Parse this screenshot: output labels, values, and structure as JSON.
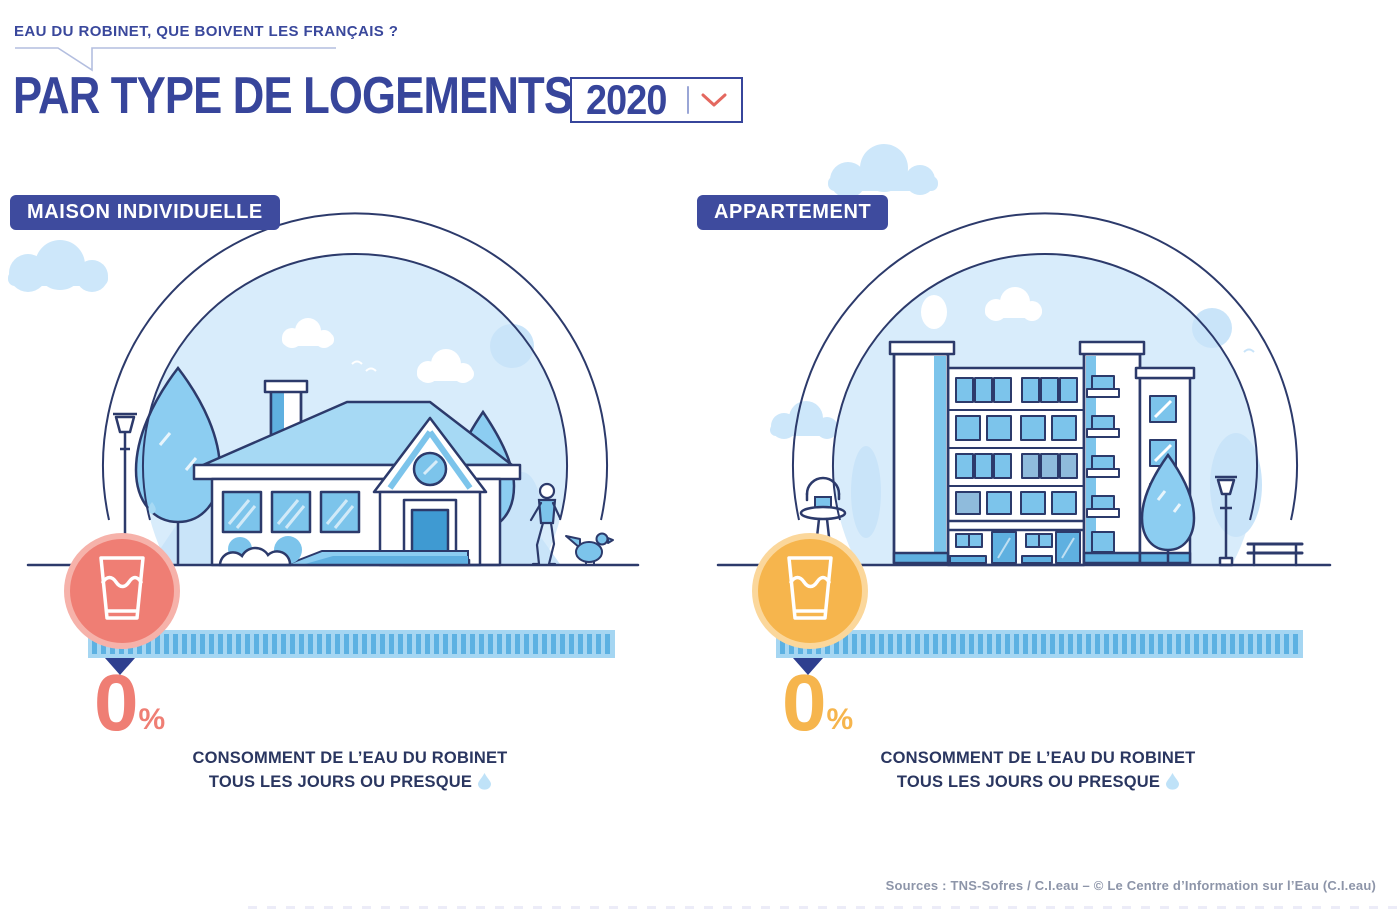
{
  "header": {
    "tagline": "EAU DU ROBINET, QUE BOIVENT LES FRANÇAIS ?",
    "title": "PAR TYPE DE LOGEMENTS",
    "year_selector": {
      "value": "2020",
      "icon": "chevron-down-icon"
    }
  },
  "panels": [
    {
      "id": "maison-individuelle",
      "label": "MAISON INDIVIDUELLE",
      "illustration": "detached-house-scene",
      "icon": "water-glass-icon",
      "accent_color": "#ef7e74",
      "ring_color": "#f6b2aa",
      "percent": "0",
      "percent_suffix": "%",
      "caption_line1": "CONSOMMENT DE L’EAU DU ROBINET",
      "caption_line2": "TOUS LES JOURS OU PRESQUE",
      "caption_icon": "water-drop-icon"
    },
    {
      "id": "appartement",
      "label": "APPARTEMENT",
      "illustration": "apartment-building-scene",
      "icon": "water-glass-icon",
      "accent_color": "#f6b54d",
      "ring_color": "#fbd79b",
      "percent": "0",
      "percent_suffix": "%",
      "caption_line1": "CONSOMMENT DE L’EAU DU ROBINET",
      "caption_line2": "TOUS LES JOURS OU PRESQUE",
      "caption_icon": "water-drop-icon"
    }
  ],
  "footer": {
    "sources": "Sources : TNS-Sofres / C.I.eau – © Le Centre d’Information sur l’Eau (C.I.eau)"
  },
  "colors": {
    "primary_navy": "#37459b",
    "badge_navy": "#3e4b9e",
    "outline_navy": "#2c3a6b",
    "sky_fill": "#d8ecfb",
    "pale_blue": "#c9e4f9",
    "mid_blue": "#7cc4eb",
    "deep_blue": "#5fb0e0",
    "bar_track": "#a5d6f2",
    "bar_stripe": "#5cb1e2",
    "pointer_navy": "#2e3f8f",
    "coral": "#ef7e74",
    "amber": "#f6b54d",
    "chevron_red": "#e4685f",
    "muted_text": "#8d95a9"
  },
  "chart_data": {
    "type": "bar",
    "title": "Eau du robinet, que boivent les Français ? — Par type de logements (2020)",
    "categories": [
      "Maison individuelle",
      "Appartement"
    ],
    "values": [
      0,
      0
    ],
    "unit": "%",
    "value_labels": [
      "0%",
      "0%"
    ],
    "note": "Consomment de l’eau du robinet tous les jours ou presque",
    "legend_position": "none",
    "xlim": [
      0,
      100
    ]
  }
}
